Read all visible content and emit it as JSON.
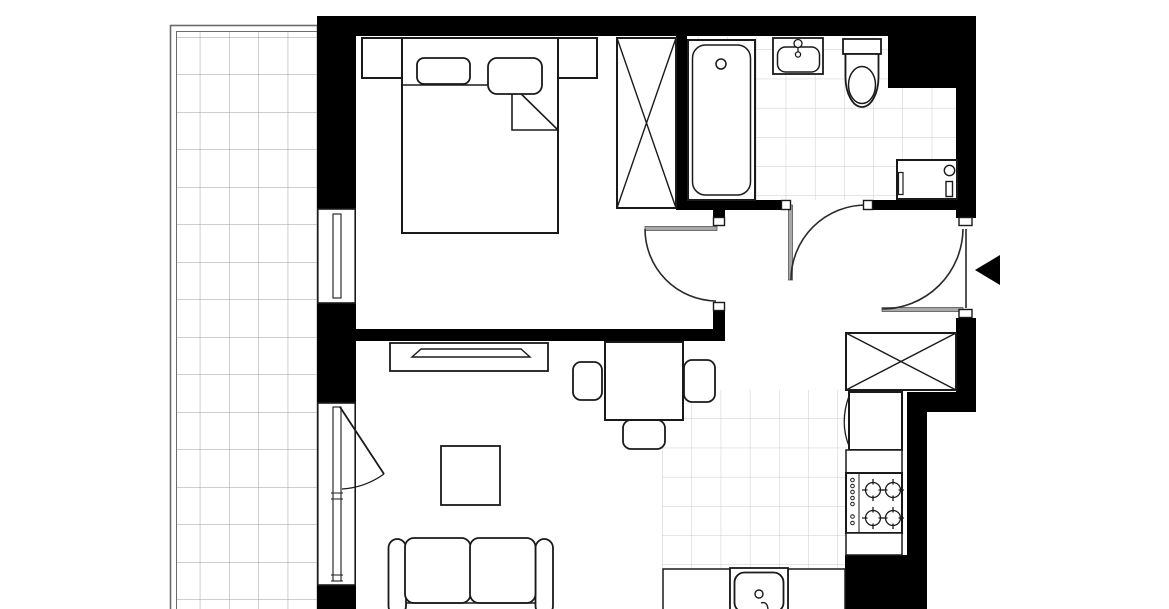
{
  "colors": {
    "background": "#ffffff",
    "wall": "#000000",
    "outline": "#1a1a1a",
    "balcony_border": "#6b6b6b",
    "balcony_grid": "#9c9c9c",
    "tile_line": "#cccccc",
    "door_leaf": "#a8a8a8",
    "door_arc": "#2a2a2a",
    "window_line": "#1a1a1a",
    "arrow": "#000000"
  },
  "icons": [
    "balcony-grid",
    "balcony-door-swing",
    "window-double-line",
    "double-bed",
    "pillow",
    "duvet-fold",
    "nightstand",
    "wardrobe-x-icon",
    "door-swing-arc",
    "door-jamb-mark",
    "bathtub",
    "washbasin",
    "faucet",
    "toilet",
    "washing-machine",
    "hall-closet-x-icon",
    "entrance-arrow-icon",
    "tv-lowboard",
    "tv",
    "dining-table",
    "chair",
    "coffee-table",
    "sofa",
    "fridge",
    "kitchen-counter",
    "cooktop-4-burners",
    "burner",
    "kitchen-sink"
  ]
}
